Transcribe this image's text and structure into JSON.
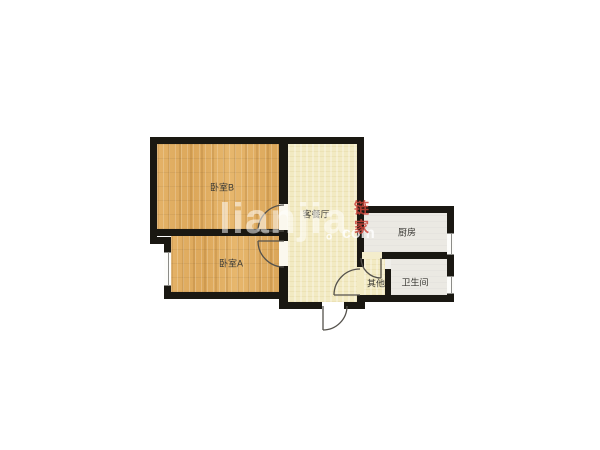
{
  "page": {
    "description": "Two-bedroom apartment floor plan, lianjia.com listing image",
    "background": "#ffffff"
  },
  "watermark": {
    "brand": "lianjia",
    "suffix": "。com",
    "logo": "链家",
    "brand_color": "rgba(255,255,255,0.52)",
    "logo_color": "#cb443a"
  },
  "rooms": {
    "bedroom_b": {
      "label": "卧室B",
      "floor": "wood",
      "floor_color": "#e0ab5f"
    },
    "bedroom_a": {
      "label": "卧室A",
      "floor": "wood",
      "floor_color": "#e0ab5f"
    },
    "living": {
      "label": "客餐厅",
      "floor": "plaster",
      "floor_color": "#f2eac2"
    },
    "kitchen": {
      "label": "厨房",
      "floor": "tile",
      "floor_color": "#ebe9e3"
    },
    "bathroom": {
      "label": "卫生间",
      "floor": "tile",
      "floor_color": "#ebe9e3"
    },
    "other": {
      "label": "其他",
      "floor": "plaster",
      "floor_color": "#f2eac2"
    }
  },
  "colors": {
    "wall": "#1a1812",
    "door_arc": "#55524c",
    "window_line": "#8c8c88",
    "label_text": "#3b3a35"
  }
}
